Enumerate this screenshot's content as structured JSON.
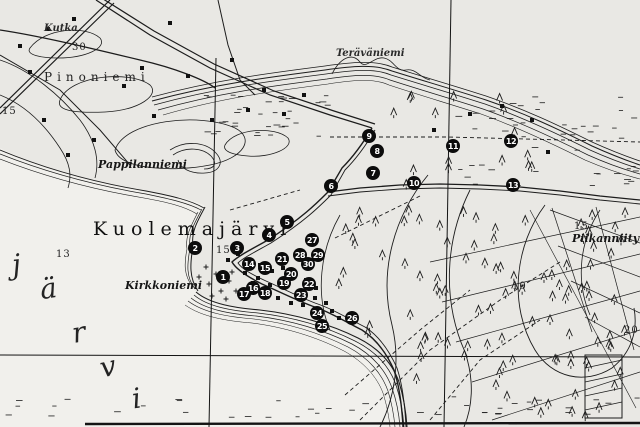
{
  "map": {
    "colors": {
      "paper": "#e9e8e4",
      "water": "#f1f0ec",
      "ink": "#1c1c1c",
      "marker_bg": "#0c0c0c",
      "marker_text": "#ffffff"
    },
    "place_labels": [
      {
        "name": "pinoniemi",
        "text": "Pinoniemi",
        "x": 44,
        "y": 70,
        "cls": "spaced-md"
      },
      {
        "name": "kutka",
        "text": "Kutka",
        "x": 44,
        "y": 23,
        "cls": "ital-xs"
      },
      {
        "name": "pappilanniemi",
        "text": "Pappilanniemi",
        "x": 98,
        "y": 158,
        "cls": "ital-sm"
      },
      {
        "name": "teravaniemi",
        "text": "Teräväniemi",
        "x": 336,
        "y": 48,
        "cls": "ital-xs"
      },
      {
        "name": "kuolemajarvi",
        "text": "Kuolemajärvi",
        "x": 93,
        "y": 218,
        "cls": "spaced-lg"
      },
      {
        "name": "kirkkoniemi",
        "text": "Kirkkoniemi",
        "x": 125,
        "y": 279,
        "cls": "ital-sm"
      },
      {
        "name": "piikanniityt",
        "text": "Piikanniityt",
        "x": 572,
        "y": 232,
        "cls": "ital-sm"
      }
    ],
    "lake_name_letters": [
      {
        "ch": "j",
        "x": 12,
        "y": 248,
        "rot": -6
      },
      {
        "ch": "ä",
        "x": 40,
        "y": 272,
        "rot": -8
      },
      {
        "ch": "r",
        "x": 72,
        "y": 316,
        "rot": -10
      },
      {
        "ch": "v",
        "x": 100,
        "y": 350,
        "rot": -12
      },
      {
        "ch": "i",
        "x": 132,
        "y": 382,
        "rot": -8
      }
    ],
    "map_numbers": [
      {
        "t": "30",
        "x": 72,
        "y": 42
      },
      {
        "t": "15",
        "x": 2,
        "y": 106
      },
      {
        "t": "13",
        "x": 56,
        "y": 249
      },
      {
        "t": "15",
        "x": 216,
        "y": 245
      },
      {
        "t": "10",
        "x": 512,
        "y": 281
      },
      {
        "t": "15",
        "x": 574,
        "y": 221
      },
      {
        "t": "20",
        "x": 624,
        "y": 325
      }
    ],
    "markers": [
      {
        "n": "1",
        "x": 223,
        "y": 277
      },
      {
        "n": "2",
        "x": 195,
        "y": 248
      },
      {
        "n": "3",
        "x": 237,
        "y": 248
      },
      {
        "n": "4",
        "x": 269,
        "y": 235
      },
      {
        "n": "5",
        "x": 287,
        "y": 222
      },
      {
        "n": "6",
        "x": 331,
        "y": 186
      },
      {
        "n": "7",
        "x": 373,
        "y": 173
      },
      {
        "n": "8",
        "x": 377,
        "y": 151
      },
      {
        "n": "9",
        "x": 369,
        "y": 136
      },
      {
        "n": "10",
        "x": 414,
        "y": 183
      },
      {
        "n": "11",
        "x": 453,
        "y": 146
      },
      {
        "n": "12",
        "x": 511,
        "y": 141
      },
      {
        "n": "13",
        "x": 513,
        "y": 185
      },
      {
        "n": "14",
        "x": 249,
        "y": 264
      },
      {
        "n": "15",
        "x": 265,
        "y": 268
      },
      {
        "n": "16",
        "x": 253,
        "y": 288
      },
      {
        "n": "17",
        "x": 244,
        "y": 294
      },
      {
        "n": "18",
        "x": 265,
        "y": 293
      },
      {
        "n": "19",
        "x": 284,
        "y": 283
      },
      {
        "n": "20",
        "x": 291,
        "y": 274
      },
      {
        "n": "21",
        "x": 282,
        "y": 259
      },
      {
        "n": "22",
        "x": 309,
        "y": 284
      },
      {
        "n": "23",
        "x": 301,
        "y": 295
      },
      {
        "n": "24",
        "x": 317,
        "y": 313
      },
      {
        "n": "25",
        "x": 322,
        "y": 326
      },
      {
        "n": "26",
        "x": 352,
        "y": 318
      },
      {
        "n": "27",
        "x": 312,
        "y": 240
      },
      {
        "n": "28",
        "x": 300,
        "y": 255
      },
      {
        "n": "29",
        "x": 318,
        "y": 255
      },
      {
        "n": "30",
        "x": 308,
        "y": 264
      }
    ]
  }
}
